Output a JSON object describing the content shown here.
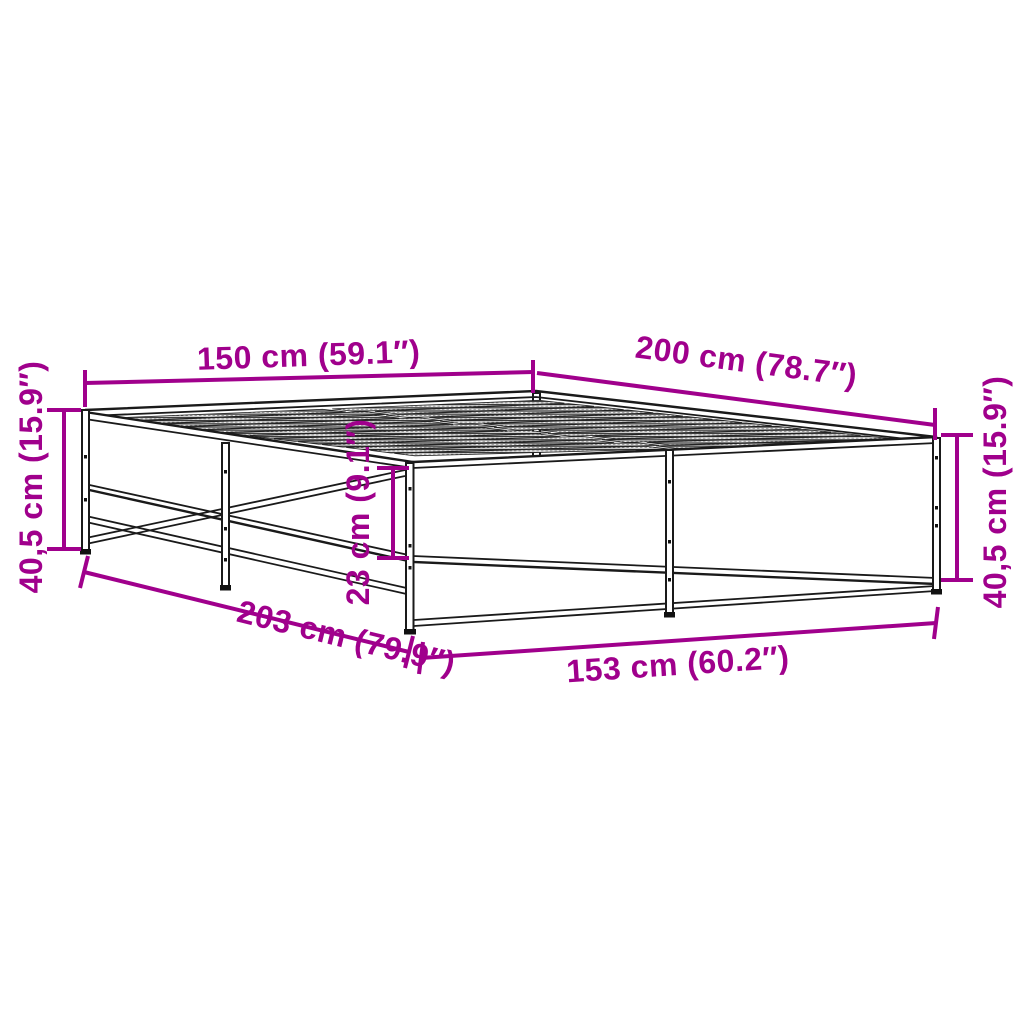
{
  "diagram": {
    "type": "product-dimension-diagram",
    "subject": "bed frame with slatted base",
    "background_color": "#ffffff",
    "line_color": "#1a1a1a",
    "dimension_color": "#A0008C",
    "labels": {
      "top_width": "150 cm (59.1″)",
      "top_length": "200 cm (78.7″)",
      "left_height": "40,5 cm (15.9″)",
      "right_height": "40,5 cm (15.9″)",
      "rail_height": "23 cm (9.1″)",
      "bottom_length": "203 cm (79.9″)",
      "bottom_width": "153 cm (60.2″)"
    }
  }
}
